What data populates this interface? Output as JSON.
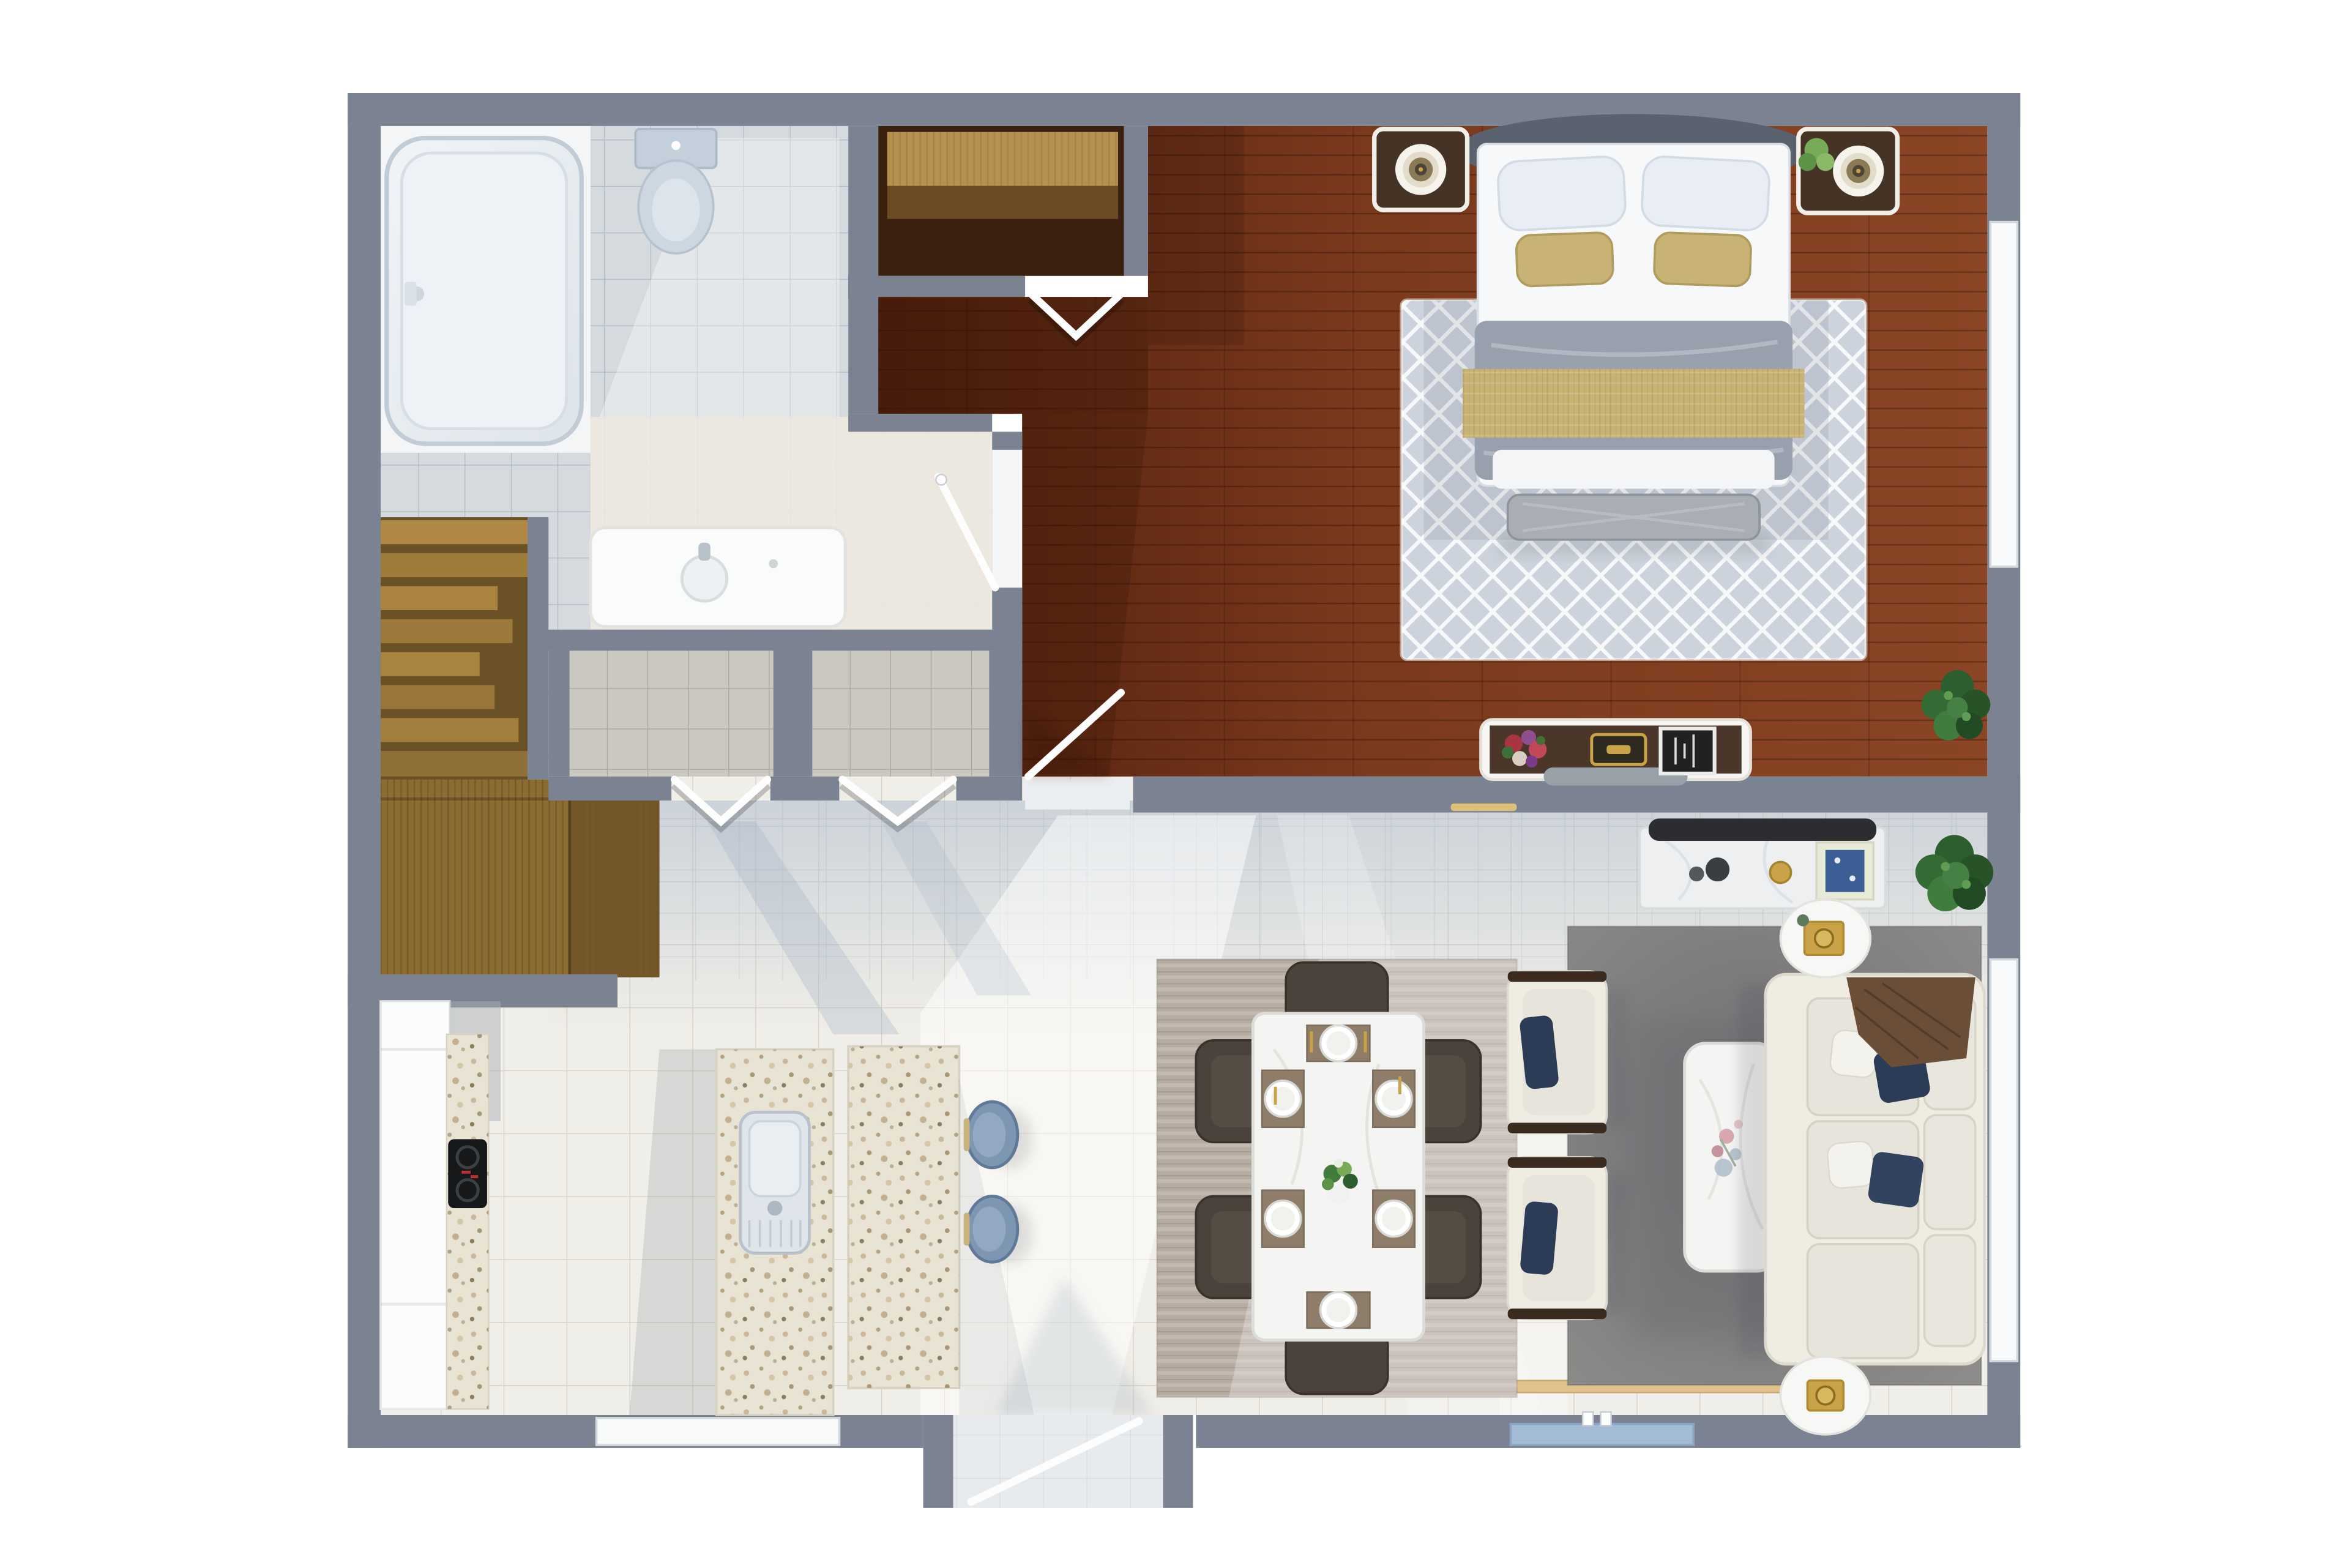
{
  "scene": {
    "type": "floor-plan",
    "style": "photorealistic 3d top-down render, no text labels",
    "rooms": [
      {
        "id": "bathroom",
        "label": "Bathroom",
        "features": [
          "bathtub",
          "toilet",
          "vanity-sink",
          "glass-shower-door"
        ]
      },
      {
        "id": "walk-in-closet",
        "label": "Walk-in Closet",
        "features": [
          "wood-shelf",
          "chevron-double-doors"
        ]
      },
      {
        "id": "bedroom",
        "label": "Bedroom",
        "features": [
          "double-bed",
          "two-nightstands",
          "two-table-lamps",
          "potted-plant",
          "diamond-pattern-rug",
          "foot-bench",
          "dresser-with-flowers",
          "corner-plant",
          "window"
        ]
      },
      {
        "id": "hallway",
        "label": "Hallway",
        "features": [
          "storage-closet-left",
          "storage-closet-right",
          "chevron-double-doors"
        ]
      },
      {
        "id": "staircase",
        "label": "Staircase",
        "features": [
          "wood-treads",
          "wood-landing"
        ]
      },
      {
        "id": "kitchen",
        "label": "Kitchen",
        "features": [
          "cabinet-run",
          "cooktop",
          "island-with-sink",
          "breakfast-bar",
          "two-bar-stools",
          "window"
        ]
      },
      {
        "id": "dining",
        "label": "Dining Area",
        "features": [
          "marble-table",
          "six-chairs",
          "six-place-settings",
          "green-centerpiece",
          "striped-rug"
        ]
      },
      {
        "id": "living",
        "label": "Living Room",
        "features": [
          "sofa",
          "two-armchairs",
          "navy-pillows",
          "brown-throw",
          "marble-coffee-table",
          "media-console",
          "tv",
          "two-round-side-tables",
          "gold-trays",
          "two-plants",
          "gray-rug",
          "french-door",
          "window"
        ]
      },
      {
        "id": "entry",
        "label": "Entry",
        "features": [
          "entry-door"
        ]
      }
    ],
    "counts": {
      "bar_stools": 2,
      "dining_chairs": 6,
      "armchairs": 2,
      "sofa_navy_pillows": 2,
      "bed_accent_pillows": 2,
      "plants": 4,
      "windows": 3,
      "chevron_door_pairs": 3
    }
  },
  "palette": {
    "wall": "#7b8291",
    "mainFloor": "#f0eee8",
    "hallTint": "#aebccd",
    "bathTile": "#d5dadf",
    "bathCream": "#eee9df",
    "tubNook": "#f3f5f7",
    "alcoveTile": "#cbc8c2",
    "closetFloor": "#39200f",
    "shelfLight": "#b5904e",
    "shelfMid": "#6d4b22",
    "stairDark": "#6a5126",
    "landing": "#8b6c33",
    "landingDark": "#6e5428",
    "bedFloorDark": "#4f1f0d",
    "bedFloorMid": "#7c3a1d",
    "bedFloorLight": "#8a4525",
    "rugBedroom": "#ccd3dc",
    "duvet": "#97a0ac",
    "tan": "#c8b375",
    "headboard": "#5a6270",
    "benchGray": "#a9adb4",
    "woodDark": "#453325",
    "navy": "#2c3c57",
    "sofaCream": "#efece2",
    "cushion": "#e6e4db",
    "throwBrown": "#6b4e38",
    "rugLiving": "#8d8c8a",
    "rugLivingDark": "#6f6e72",
    "rugDining": "#b7aca1",
    "chairBrown": "#4b433b",
    "marble": "#f4f4f3",
    "islandStone": "#e9e3d3",
    "stoolBlue": "#7d96b2",
    "gold": "#caa348",
    "tvDark": "#2b2d31",
    "plantDark": "#2d5e2f",
    "plantMid": "#3f7c3e",
    "plantLight": "#79aa57",
    "windowWhite": "#f8fafb",
    "windowBlue": "#a2bcd6",
    "sillTan": "#dfc28e",
    "doorWhite": "#fdfdfd",
    "lightStrip": "#e8c874"
  }
}
